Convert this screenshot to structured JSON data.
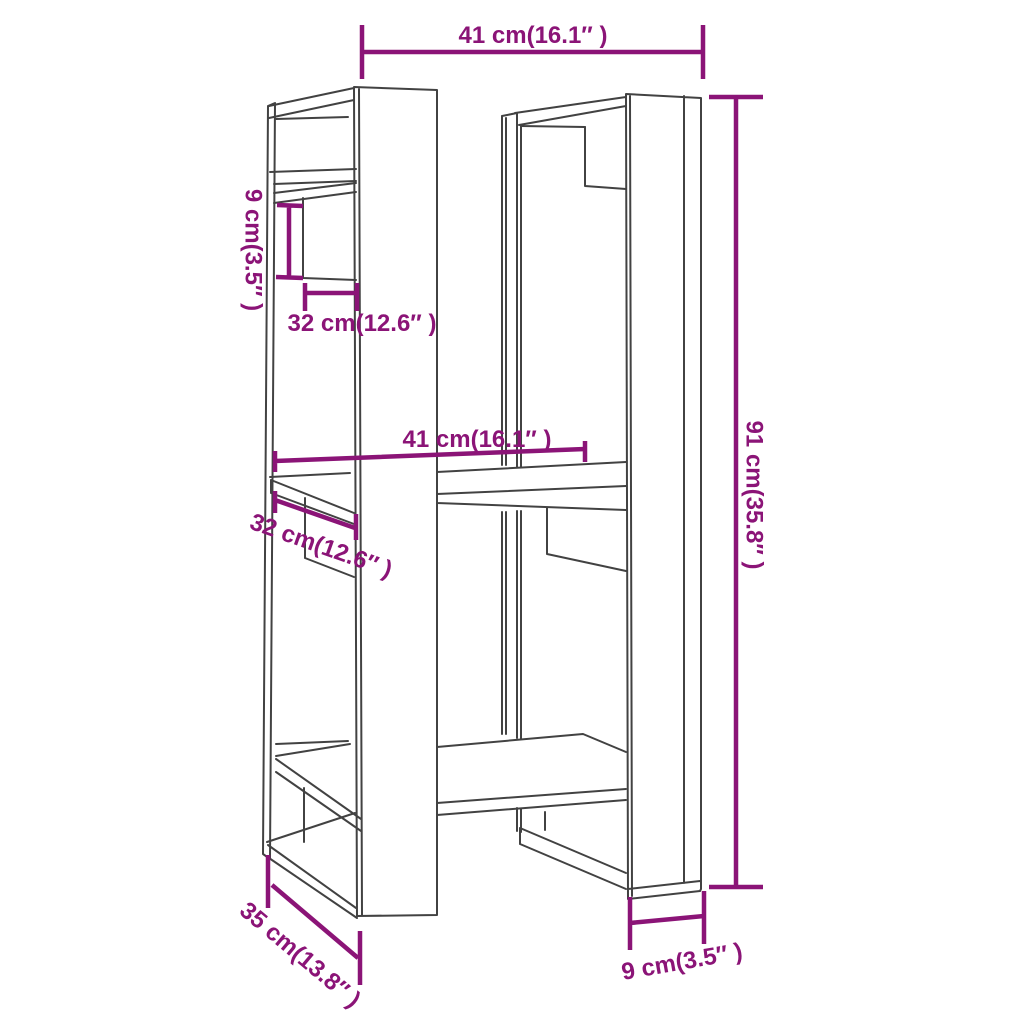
{
  "image": {
    "width": 1024,
    "height": 1024,
    "background": "#ffffff"
  },
  "colors": {
    "dimension": "#8b1477",
    "drawing": "#424242"
  },
  "diagram": {
    "type": "product-dimension-diagram",
    "subject": "book cabinet / room divider line drawing with staggered shelves",
    "dimensions": [
      {
        "id": "top_width",
        "label": "41 cm(16.1″ )",
        "value_cm": 41,
        "value_in": 16.1,
        "orientation": "horizontal",
        "position": "top"
      },
      {
        "id": "overall_height",
        "label": "91 cm(35.8″ )",
        "value_cm": 91,
        "value_in": 35.8,
        "orientation": "vertical",
        "position": "right"
      },
      {
        "id": "board_height",
        "label": "9 cm(3.5″ )",
        "value_cm": 9,
        "value_in": 3.5,
        "orientation": "vertical",
        "position": "upper-left"
      },
      {
        "id": "shelf_depth_upper",
        "label": "32 cm(12.6″ )",
        "value_cm": 32,
        "value_in": 12.6,
        "orientation": "horizontal",
        "position": "upper-left"
      },
      {
        "id": "inner_width",
        "label": "41 cm(16.1″ )",
        "value_cm": 41,
        "value_in": 16.1,
        "orientation": "horizontal",
        "position": "middle"
      },
      {
        "id": "shelf_depth_lower",
        "label": "32 cm(12.6″ )",
        "value_cm": 32,
        "value_in": 12.6,
        "orientation": "diagonal",
        "position": "middle-left"
      },
      {
        "id": "total_depth",
        "label": "35 cm(13.8″ )",
        "value_cm": 35,
        "value_in": 13.8,
        "orientation": "diagonal",
        "position": "bottom-left"
      },
      {
        "id": "base_board_width",
        "label": "9 cm(3.5″ )",
        "value_cm": 9,
        "value_in": 3.5,
        "orientation": "horizontal",
        "position": "bottom-right"
      }
    ]
  }
}
